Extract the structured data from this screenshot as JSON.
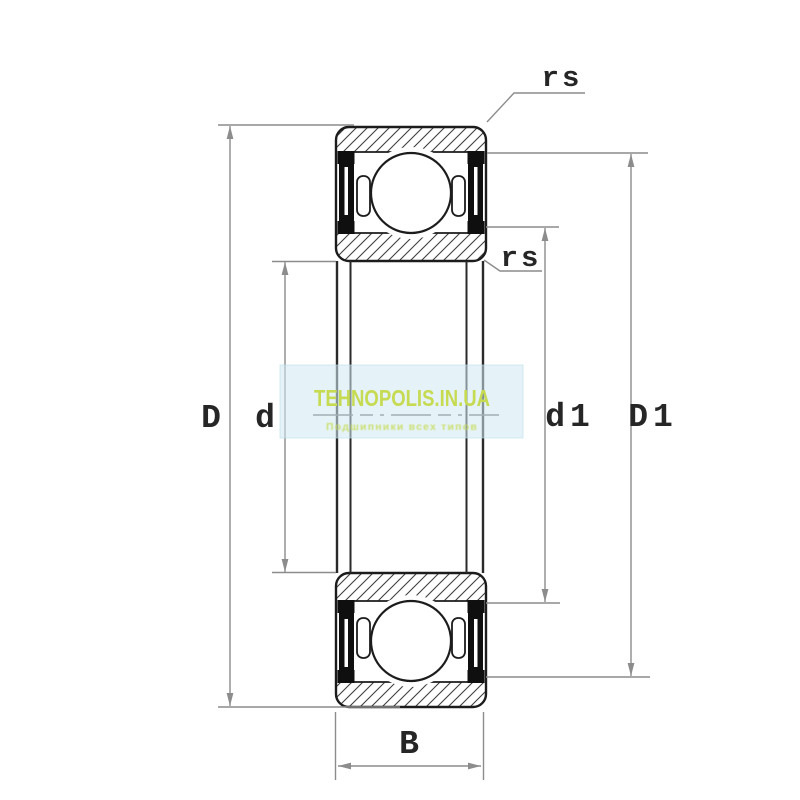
{
  "diagram": {
    "type": "deep groove ball bearing 2RS cross-section drawing",
    "dimension_labels": {
      "D": "D",
      "d": "d",
      "d1": "d1",
      "D1": "D1",
      "B": "B",
      "rs_top": "rs",
      "rs_mid": "rs"
    }
  },
  "watermark": {
    "site": "TEHNOPOLIS.IN.UA",
    "tagline": "Подшипники всех типов"
  },
  "colors": {
    "background": "#ffffff",
    "outline": "#1c1c1c",
    "hatch": "#3f3f3f",
    "seal": "#0f0f0f",
    "dimension_line": "#8c8c8c",
    "watermark_band": "#cfe9f2",
    "watermark_text": "#c6da52"
  }
}
